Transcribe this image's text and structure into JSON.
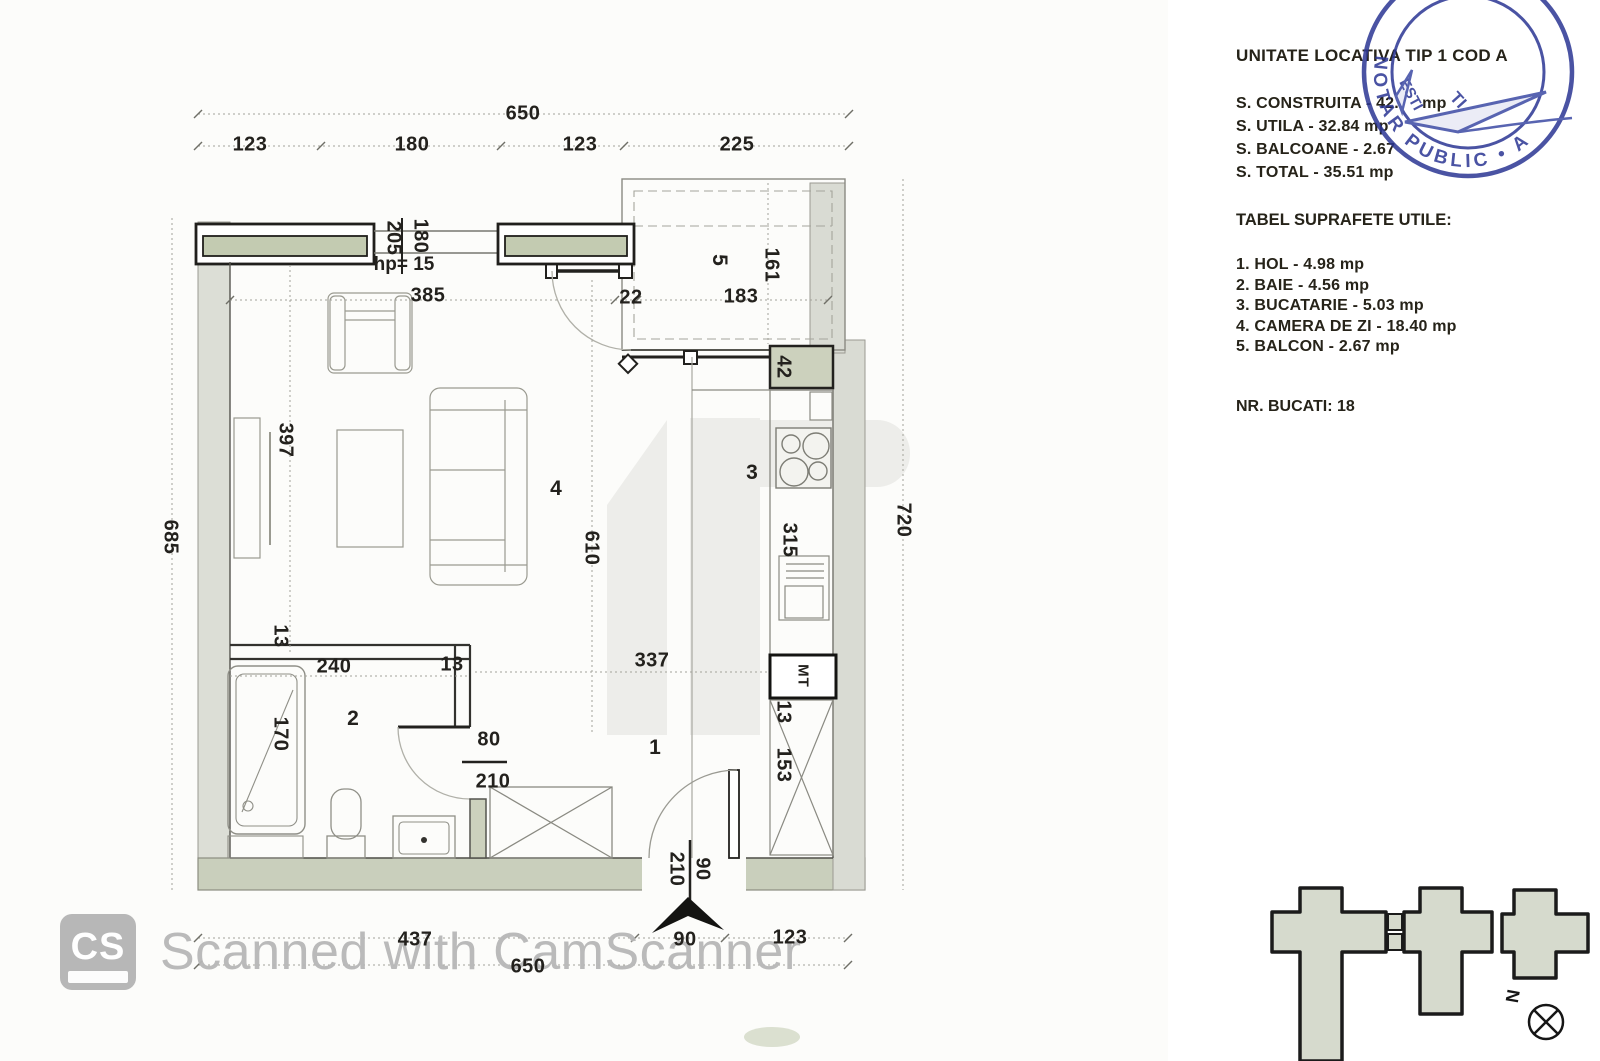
{
  "plan": {
    "rooms": {
      "hol": "1",
      "baie": "2",
      "bucatarie": "3",
      "camera_de_zi": "4",
      "balcon": "5"
    },
    "dims": {
      "top_total": "650",
      "top_seg1": "123",
      "top_seg2": "180",
      "top_seg3": "123",
      "top_seg4": "225",
      "left_total": "685",
      "right_total": "720",
      "bottom_seg1": "437",
      "bottom_seg2": "90",
      "bottom_seg3": "123",
      "bottom_total": "650",
      "living_width": "385",
      "balcony_gap": "22",
      "balcony_width": "183",
      "balcony_depth": "161",
      "window_h1": "205",
      "window_h2": "180",
      "wall_stub": "42",
      "tv_wall": "397",
      "living_depth": "610",
      "kitchen_counter": "315",
      "bath_wall_thk": "13",
      "bath_width": "240",
      "bath_wall2": "13",
      "hall_width": "337",
      "right_wall_thk": "13",
      "wardrobe": "153",
      "bathtub": "170",
      "bath_door_w": "80",
      "bath_door_h": "210",
      "entry_door_w": "90",
      "entry_door_h": "210"
    },
    "labels": {
      "parapet": "hp= 15",
      "boiler": "MT"
    }
  },
  "info": {
    "title": "UNITATE LOCATIVA TIP 1 COD A",
    "area1": "S. CONSTRUITA - 42.     mp",
    "area2": "S. UTILA - 32.84 mp",
    "area3": "S. BALCOANE - 2.67",
    "area4": "S. TOTAL - 35.51 mp",
    "table_title": "TABEL SUPRAFETE UTILE:",
    "row1": "1. HOL - 4.98 mp",
    "row2": "2. BAIE - 4.56 mp",
    "row3": "3. BUCATARIE - 5.03 mp",
    "row4": "4. CAMERA DE ZI  - 18.40 mp",
    "row5": "5. BALCON - 2.67 mp",
    "nr_bucati": "NR. BUCATI: 18"
  },
  "stamp": {
    "arc_text": "NOTAR PUBLIC • A",
    "fragment1": "ESTI",
    "fragment2": "TI",
    "color": "#2b3694"
  },
  "scanner": {
    "logo": "CS",
    "text": "Scanned with CamScanner"
  },
  "keyplan": {
    "compass": "N"
  }
}
